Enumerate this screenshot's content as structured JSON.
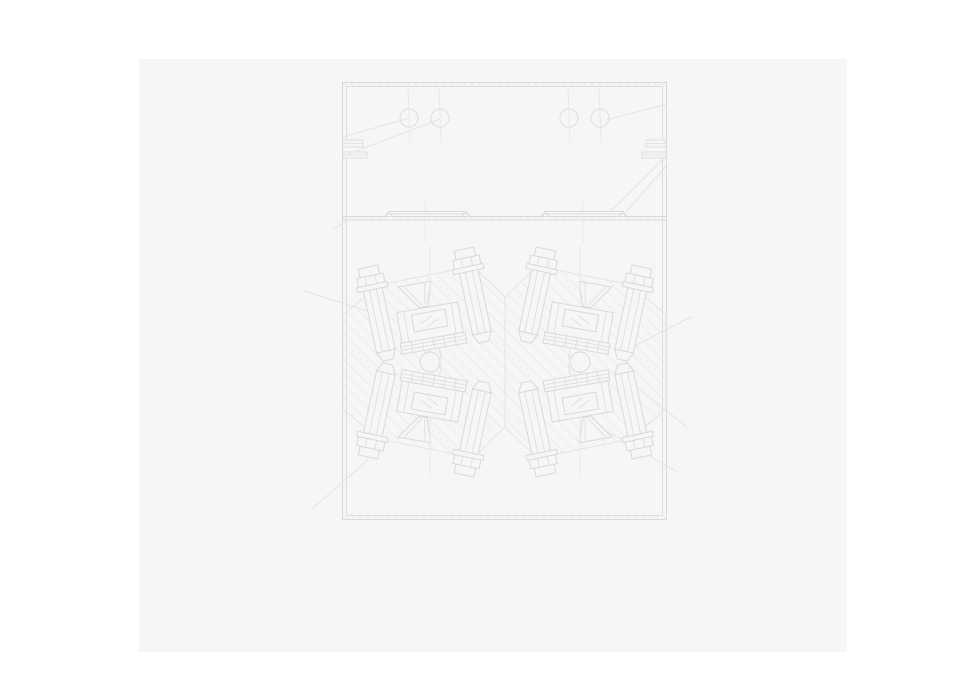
{
  "colors": {
    "page_bg": "#ffffff",
    "panel_bg": "#f6f6f7",
    "line_strong": "#d9d9db",
    "line_main": "#dedee0",
    "line_soft": "#e4e4e6",
    "line_hatch": "#ececee",
    "line_fine": "#e8e8ea"
  },
  "panel": {
    "x": 139,
    "y": 59,
    "w": 708,
    "h": 593
  },
  "drawing": {
    "frame": {
      "x": 203.5,
      "y": 23.5,
      "w": 324,
      "h": 437,
      "inset": 4
    },
    "top_circles": {
      "cy": 59,
      "r": 9,
      "cx": [
        270,
        301,
        430,
        461
      ],
      "centerline_y1": 29,
      "centerline_y2": 83
    },
    "divider": {
      "y1": 157.5,
      "y2": 161,
      "x1": 204,
      "x2": 527
    },
    "rails": [
      {
        "x1": 246,
        "x2": 331,
        "cx": 286
      },
      {
        "x1": 402,
        "x2": 488,
        "cx": 444
      }
    ],
    "notch_feet": [
      {
        "x": 204,
        "y": 81,
        "w": 20,
        "h": 7
      },
      {
        "x": 204,
        "y": 93,
        "w": 24,
        "h": 6
      },
      {
        "x": 507,
        "y": 81,
        "w": 20,
        "h": 7
      },
      {
        "x": 503,
        "y": 93,
        "w": 24,
        "h": 6
      }
    ],
    "body_outline": "204,256 240,226 334,207 366,238 398,207 492,226 527,256 527,350 492,380 398,399 366,368 334,399 240,380 204,350",
    "center_axis": {
      "x": 366,
      "y1": 238,
      "y2": 368
    },
    "bolt_rot": -12,
    "bolts": [
      {
        "x": 239,
        "y": 255,
        "sx": 1,
        "sy": 1
      },
      {
        "x": 335,
        "y": 237,
        "sx": 1,
        "sy": 1
      },
      {
        "x": 397,
        "y": 237,
        "sx": -1,
        "sy": 1
      },
      {
        "x": 493,
        "y": 255,
        "sx": -1,
        "sy": 1
      },
      {
        "x": 239,
        "y": 351,
        "sx": 1,
        "sy": -1
      },
      {
        "x": 335,
        "y": 369,
        "sx": 1,
        "sy": -1
      },
      {
        "x": 397,
        "y": 369,
        "sx": -1,
        "sy": -1
      },
      {
        "x": 493,
        "y": 351,
        "sx": -1,
        "sy": -1
      }
    ],
    "clamp_rot": -10,
    "clamps": [
      {
        "x": 291,
        "y": 264,
        "sx": 1,
        "sy": 1
      },
      {
        "x": 441,
        "y": 264,
        "sx": -1,
        "sy": 1
      },
      {
        "x": 291,
        "y": 342,
        "sx": 1,
        "sy": -1
      },
      {
        "x": 441,
        "y": 342,
        "sx": -1,
        "sy": -1
      }
    ],
    "pivots": {
      "r": 10,
      "centers": [
        {
          "cx": 291,
          "cy": 303
        },
        {
          "cx": 441,
          "cy": 303
        }
      ]
    },
    "leaders": [
      [
        204,
        78,
        270,
        59
      ],
      [
        204,
        97,
        301,
        60
      ],
      [
        527,
        45,
        468,
        61
      ],
      [
        527,
        97,
        472,
        152
      ],
      [
        527,
        107,
        488,
        152
      ],
      [
        480,
        295,
        552,
        258
      ],
      [
        500,
        330,
        548,
        368
      ],
      [
        165,
        232,
        235,
        254
      ],
      [
        194,
        170,
        209,
        161
      ],
      [
        230,
        400,
        173,
        450
      ],
      [
        456,
        365,
        540,
        414
      ]
    ]
  }
}
